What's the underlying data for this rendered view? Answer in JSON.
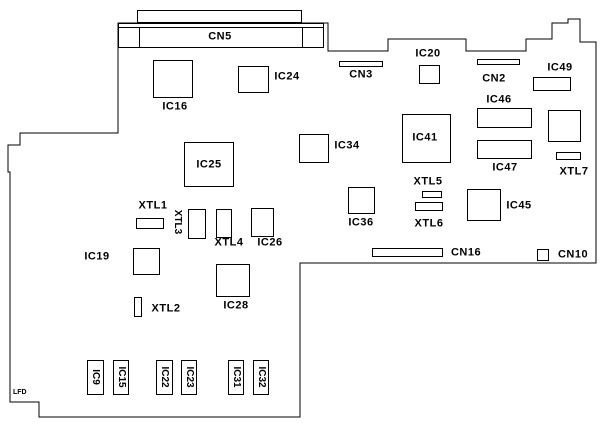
{
  "diagram": {
    "colors": {
      "background": "#ffffff",
      "line": "#000000",
      "text": "#000000"
    },
    "board_outline_points": "118,23 328,23 328,51 388,51 388,39 466,39 466,51 526,51 526,39 552,39 552,23 568,23 568,19 580,19 580,42 596,42 596,263 300,263 300,417 39,417 39,402 10,402 10,172 8,172 8,145 20,145 20,133 118,133",
    "corner_text": "LFD",
    "cn5": {
      "label": "CN5",
      "shell": {
        "x": 137,
        "y": 10,
        "w": 165,
        "h": 13
      },
      "body": {
        "x": 118,
        "y": 23,
        "w": 206,
        "h": 25
      },
      "inner_line_y": 27,
      "dividers_x": [
        139,
        302
      ],
      "label_at": [
        220,
        37
      ]
    },
    "components": [
      {
        "id": "ic16",
        "label": "IC16",
        "rect": [
          153,
          60,
          40,
          38
        ],
        "label_at": [
          175,
          107
        ]
      },
      {
        "id": "ic24",
        "label": "IC24",
        "rect": [
          238,
          66,
          31,
          27
        ],
        "label_at": [
          287,
          77
        ]
      },
      {
        "id": "cn3",
        "label": "CN3",
        "rect": [
          339,
          61,
          44,
          6
        ],
        "label_at": [
          361,
          75
        ]
      },
      {
        "id": "ic20",
        "label": "IC20",
        "rect": [
          419,
          65,
          21,
          19
        ],
        "label_at": [
          428,
          54
        ]
      },
      {
        "id": "cn2",
        "label": "CN2",
        "rect": [
          477,
          59,
          43,
          6
        ],
        "label_at": [
          494,
          79
        ]
      },
      {
        "id": "ic49",
        "label": "IC49",
        "rect": [
          533,
          77,
          38,
          14
        ],
        "label_at": [
          560,
          68
        ]
      },
      {
        "id": "ic46",
        "label": "IC46",
        "rect": [
          477,
          108,
          55,
          20
        ],
        "label_at": [
          499,
          100
        ]
      },
      {
        "id": "ic41",
        "label": "IC41",
        "rect": [
          402,
          114,
          49,
          49
        ],
        "label_at": [
          425,
          138
        ]
      },
      {
        "id": "ic47",
        "label": "IC47",
        "rect": [
          477,
          140,
          55,
          19
        ],
        "label_at": [
          505,
          168
        ]
      },
      {
        "id": "ic-unlabeled",
        "label": "",
        "rect": [
          548,
          110,
          33,
          32
        ],
        "label_at": [
          0,
          0
        ]
      },
      {
        "id": "xtl7",
        "label": "XTL7",
        "rect": [
          556,
          152,
          25,
          8
        ],
        "label_at": [
          574,
          172
        ]
      },
      {
        "id": "ic34",
        "label": "IC34",
        "rect": [
          299,
          134,
          30,
          29
        ],
        "label_at": [
          347,
          146
        ]
      },
      {
        "id": "ic25",
        "label": "IC25",
        "rect": [
          184,
          142,
          50,
          45
        ],
        "label_at": [
          209,
          165
        ]
      },
      {
        "id": "xtl5",
        "label": "XTL5",
        "rect": [
          422,
          191,
          20,
          7
        ],
        "label_at": [
          428,
          182
        ]
      },
      {
        "id": "xtl6",
        "label": "XTL6",
        "rect": [
          415,
          202,
          28,
          9
        ],
        "label_at": [
          429,
          224
        ]
      },
      {
        "id": "ic36",
        "label": "IC36",
        "rect": [
          348,
          187,
          27,
          27
        ],
        "label_at": [
          361,
          223
        ]
      },
      {
        "id": "ic45",
        "label": "IC45",
        "rect": [
          467,
          189,
          34,
          32
        ],
        "label_at": [
          519,
          206
        ]
      },
      {
        "id": "xtl1",
        "label": "XTL1",
        "rect": [
          136,
          218,
          28,
          11
        ],
        "label_at": [
          153,
          206
        ]
      },
      {
        "id": "xtl3",
        "label": "XTL3",
        "rect": [
          188,
          209,
          18,
          30
        ],
        "label_at": [
          177,
          222
        ],
        "rotated": true
      },
      {
        "id": "xtl4",
        "label": "XTL4",
        "rect": [
          216,
          209,
          16,
          29
        ],
        "label_at": [
          229,
          243
        ]
      },
      {
        "id": "ic26",
        "label": "IC26",
        "rect": [
          251,
          208,
          23,
          29
        ],
        "label_at": [
          270,
          243
        ]
      },
      {
        "id": "ic19",
        "label": "IC19",
        "rect": [
          133,
          248,
          27,
          27
        ],
        "label_at": [
          97,
          257
        ]
      },
      {
        "id": "xtl2",
        "label": "XTL2",
        "rect": [
          134,
          297,
          8,
          20
        ],
        "label_at": [
          166,
          309
        ]
      },
      {
        "id": "ic28",
        "label": "IC28",
        "rect": [
          216,
          264,
          34,
          33
        ],
        "label_at": [
          236,
          306
        ]
      },
      {
        "id": "cn16",
        "label": "CN16",
        "rect": [
          372,
          248,
          71,
          9
        ],
        "label_at": [
          466,
          253
        ]
      },
      {
        "id": "cn10",
        "label": "CN10",
        "rect": [
          537,
          249,
          12,
          12
        ],
        "label_at": [
          573,
          255
        ]
      },
      {
        "id": "ic9",
        "label": "IC9",
        "rect": [
          87,
          360,
          17,
          35
        ],
        "label_at": [
          95,
          377
        ],
        "rotated": true
      },
      {
        "id": "ic15",
        "label": "IC15",
        "rect": [
          113,
          360,
          16,
          35
        ],
        "label_at": [
          121,
          377
        ],
        "rotated": true
      },
      {
        "id": "ic22",
        "label": "IC22",
        "rect": [
          156,
          360,
          17,
          35
        ],
        "label_at": [
          164,
          377
        ],
        "rotated": true
      },
      {
        "id": "ic23",
        "label": "IC23",
        "rect": [
          181,
          360,
          16,
          35
        ],
        "label_at": [
          189,
          377
        ],
        "rotated": true
      },
      {
        "id": "ic31",
        "label": "IC31",
        "rect": [
          228,
          360,
          16,
          35
        ],
        "label_at": [
          236,
          377
        ],
        "rotated": true
      },
      {
        "id": "ic32",
        "label": "IC32",
        "rect": [
          253,
          360,
          16,
          35
        ],
        "label_at": [
          261,
          377
        ],
        "rotated": true
      }
    ]
  }
}
